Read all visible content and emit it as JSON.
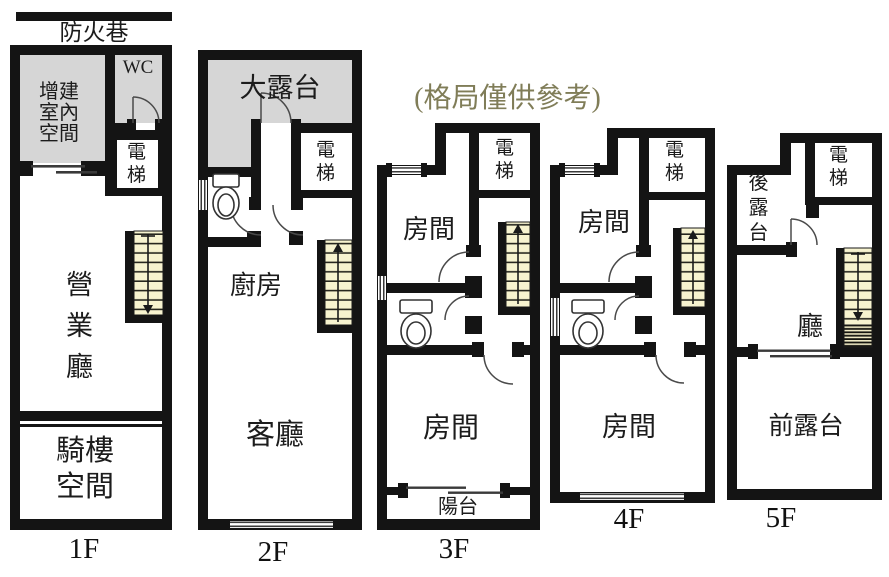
{
  "note": {
    "text": "(格局僅供參考)",
    "color": "#807d58"
  },
  "fire_lane": "防火巷",
  "colors": {
    "wall": "#141414",
    "shaded_area": "#d6d6d6",
    "stairs_fill": "#f7f3cf",
    "background": "#ffffff"
  },
  "floors": [
    {
      "label": "1F",
      "rooms": {
        "annex": "增建室內空間",
        "wc": "WC",
        "elevator": "電梯",
        "business_hall": "營業廳",
        "arcade": "騎樓空間"
      }
    },
    {
      "label": "2F",
      "rooms": {
        "terrace": "大露台",
        "elevator": "電梯",
        "kitchen": "廚房",
        "living_room": "客廳"
      }
    },
    {
      "label": "3F",
      "rooms": {
        "elevator": "電梯",
        "room_upper": "房間",
        "room_lower": "房間",
        "balcony": "陽台"
      }
    },
    {
      "label": "4F",
      "rooms": {
        "elevator": "電梯",
        "room_upper": "房間",
        "room_lower": "房間"
      }
    },
    {
      "label": "5F",
      "rooms": {
        "elevator": "電梯",
        "rear_terrace": "後露台",
        "hall": "廳",
        "front_terrace": "前露台"
      }
    }
  ]
}
